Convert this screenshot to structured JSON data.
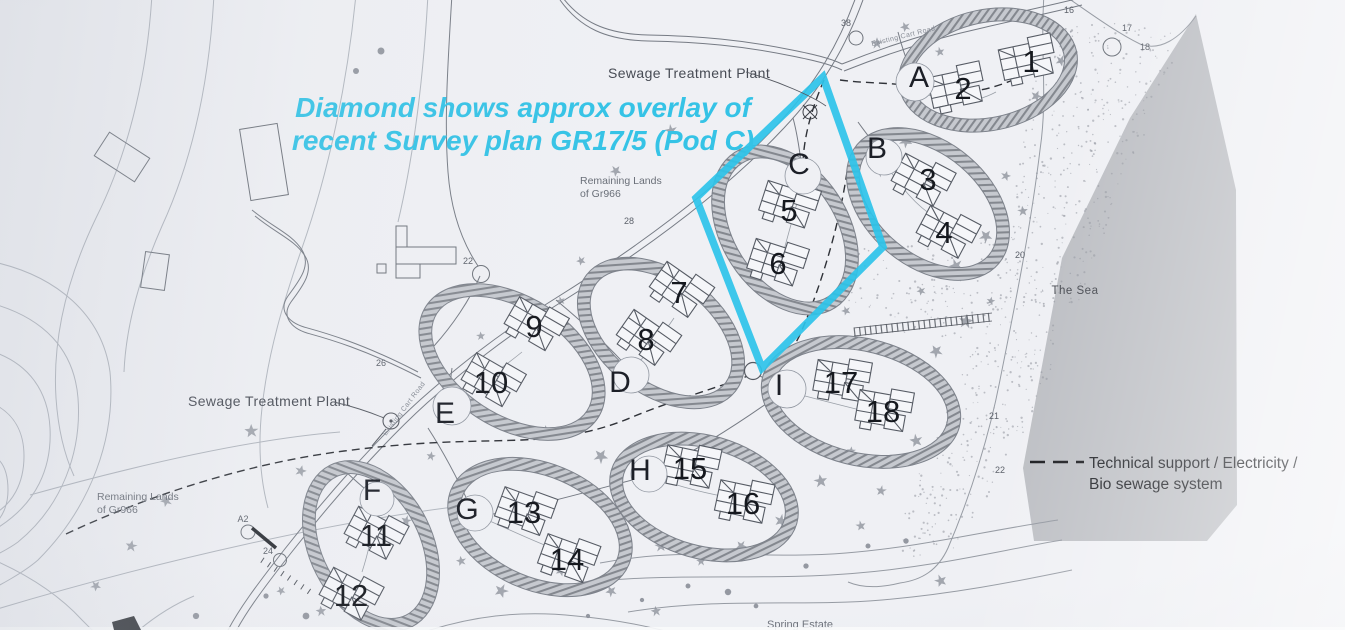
{
  "annotation": {
    "line1": "Diamond shows approx overlay of",
    "line2": "recent  Survey plan GR17/5 (Pod C)"
  },
  "place_labels": {
    "sewage_plant_top": "Sewage Treatment Plant",
    "sewage_plant_left": "Sewage Treatment Plant",
    "remaining_lands_top_line1": "Remaining Lands",
    "remaining_lands_top_line2": "of Gr966",
    "remaining_lands_left_line1": "Remaining Lands",
    "remaining_lands_left_line2": "of Gr966",
    "the_sea": "The Sea",
    "spring_estate": "Spring Estate",
    "cart_road_top": "Existing Cart Road",
    "cart_road_mid": "Existing Cart Road"
  },
  "legend": {
    "line1": "Technical support / Electricity /",
    "line2": "Bio sewage system"
  },
  "pods": [
    {
      "letter": "A",
      "houses": [
        "1",
        "2"
      ]
    },
    {
      "letter": "B",
      "houses": [
        "3",
        "4"
      ]
    },
    {
      "letter": "C",
      "houses": [
        "5",
        "6"
      ]
    },
    {
      "letter": "D",
      "houses": [
        "7",
        "8"
      ]
    },
    {
      "letter": "E",
      "houses": [
        "9",
        "10"
      ]
    },
    {
      "letter": "F",
      "houses": [
        "11",
        "12"
      ]
    },
    {
      "letter": "G",
      "houses": [
        "13",
        "14"
      ]
    },
    {
      "letter": "H",
      "houses": [
        "15",
        "16"
      ]
    },
    {
      "letter": "I",
      "houses": [
        "17",
        "18"
      ]
    }
  ],
  "road_markers": [
    {
      "label": "38"
    },
    {
      "label": "28"
    },
    {
      "label": "26"
    },
    {
      "label": "22"
    },
    {
      "label": "A2"
    },
    {
      "label": "24"
    },
    {
      "label": "16"
    },
    {
      "label": "17"
    },
    {
      "label": "18"
    },
    {
      "label": "20"
    },
    {
      "label": "21"
    },
    {
      "label": "22"
    }
  ],
  "colors": {
    "diamond_overlay": "#2ec3e9",
    "annotation_text": "#35c3e6",
    "sea": "#bdbfc4",
    "paper": "#eff0f4"
  }
}
